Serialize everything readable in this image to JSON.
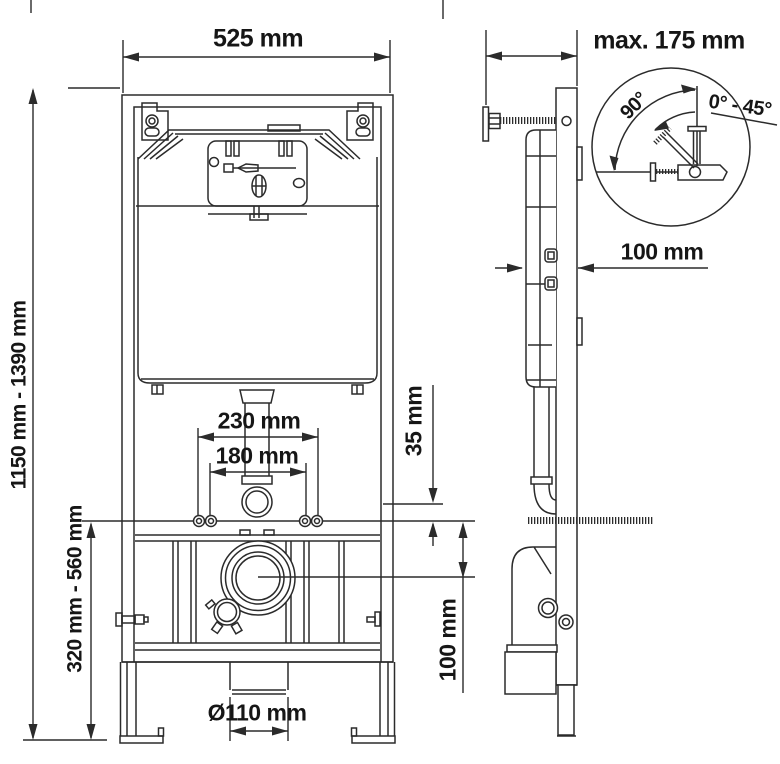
{
  "page": {
    "type": "technical dimension drawing",
    "subject": "concealed cistern installation frame for wall-hung WC",
    "background": "#ffffff"
  },
  "colors": {
    "line": "#2b2b2b",
    "text": "#161616"
  },
  "views": {
    "front": {
      "name": "front view",
      "dimensions": {
        "width": "525 mm",
        "height_range": "1150 mm - 1390 mm",
        "lower_height_range": "320 mm - 560 mm",
        "stud_spacing_outer": "230 mm",
        "stud_spacing_inner": "180 mm",
        "flush_elbow_offset": "35 mm",
        "drain_center_offset": "100 mm",
        "drain_diameter": "Ø110 mm"
      }
    },
    "side": {
      "name": "side view",
      "dimensions": {
        "wall_distance_max": "max. 175 mm",
        "frame_depth": "100 mm"
      }
    },
    "detail": {
      "name": "wall bracket angle detail",
      "dimensions": {
        "angle_fixed": "90°",
        "angle_range": "0° - 45°"
      }
    }
  }
}
